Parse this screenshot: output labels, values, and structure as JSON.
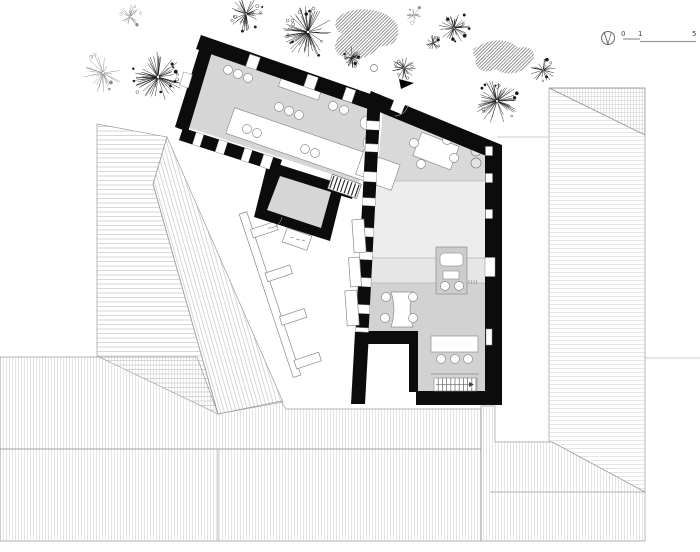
{
  "canvas": {
    "width": 700,
    "height": 552,
    "background": "#ffffff"
  },
  "scalebar": {
    "labels": [
      "0",
      "1",
      "5"
    ]
  },
  "colors": {
    "wall": "#0c0c0c",
    "roof_stroke": "#9c9c9c",
    "faint_line": "#bcbcbc",
    "floor_hall": "#d6d6d6",
    "floor_room1": "#d9d9d9",
    "floor_room2": "#ededed",
    "floor_band": "#e6e6e6",
    "floor_room3": "#d2d2d2",
    "kitchen_block": "#cccccc",
    "furniture_stroke": "#8f8f8f",
    "tree_dark": "#1a1a1a",
    "tree_light": "#8a8a8a"
  },
  "site": {
    "roofs": [
      {
        "name": "barn-roof-west-plane",
        "points": [
          [
            97,
            124
          ],
          [
            167,
            137
          ],
          [
            153,
            184
          ],
          [
            218,
            414
          ],
          [
            97,
            356
          ]
        ],
        "hatch": "hbarn"
      },
      {
        "name": "barn-roof-east-plane",
        "points": [
          [
            167,
            137
          ],
          [
            283,
            402
          ],
          [
            218,
            414
          ],
          [
            153,
            184
          ]
        ],
        "hatch": "hsteep"
      },
      {
        "name": "south-roof-upper",
        "points": [
          [
            0,
            357
          ],
          [
            197,
            357
          ],
          [
            218,
            414
          ],
          [
            281,
            401
          ],
          [
            286,
            409
          ],
          [
            481,
            409
          ],
          [
            481,
            449
          ],
          [
            0,
            449
          ]
        ],
        "hatch": "hv"
      },
      {
        "name": "south-roof-lower",
        "points": [
          [
            0,
            449
          ],
          [
            481,
            449
          ],
          [
            481,
            541
          ],
          [
            0,
            541
          ]
        ],
        "hatch": "hv"
      },
      {
        "name": "southeast-roof",
        "points": [
          [
            481,
            406
          ],
          [
            495,
            406
          ],
          [
            495,
            442
          ],
          [
            552,
            442
          ],
          [
            645,
            492
          ],
          [
            645,
            541
          ],
          [
            481,
            541
          ]
        ],
        "hatch": "hv"
      },
      {
        "name": "east-roof",
        "points": [
          [
            549,
            88
          ],
          [
            645,
            88
          ],
          [
            645,
            492
          ],
          [
            552,
            442
          ],
          [
            549,
            442
          ]
        ],
        "hatch": "hh"
      },
      {
        "name": "east-roof-hip",
        "points": [
          [
            549,
            88
          ],
          [
            645,
            88
          ],
          [
            645,
            135
          ]
        ],
        "hatch": "hv"
      }
    ],
    "ridge_lines": [
      [
        [
          153,
          184
        ],
        [
          218,
          414
        ]
      ],
      [
        [
          218,
          449
        ],
        [
          218,
          541
        ]
      ],
      [
        [
          490,
          492
        ],
        [
          645,
          492
        ]
      ],
      [
        [
          549,
          88
        ],
        [
          645,
          135
        ]
      ]
    ],
    "faint_lines": [
      [
        [
          497,
          137
        ],
        [
          548,
          137
        ]
      ],
      [
        [
          645,
          358
        ],
        [
          700,
          358
        ]
      ]
    ],
    "hedges": [
      "M347,12 C366,5 391,12 397,25 C402,37 393,48 380,46 C372,58 352,63 341,56 C331,50 335,40 342,34 C331,28 334,17 347,12 Z",
      "M481,45 C493,38 511,39 518,48 C531,44 539,54 531,63 C523,74 504,77 496,69 C485,75 473,69 476,58 C470,51 473,48 481,45 Z"
    ],
    "trees": [
      {
        "x": 103,
        "y": 73,
        "r": 20,
        "n": 26,
        "light": true
      },
      {
        "x": 158,
        "y": 77,
        "r": 26,
        "n": 55,
        "light": false
      },
      {
        "x": 130,
        "y": 17,
        "r": 13,
        "n": 22,
        "light": true
      },
      {
        "x": 246,
        "y": 14,
        "r": 17,
        "n": 38,
        "light": false
      },
      {
        "x": 308,
        "y": 32,
        "r": 26,
        "n": 58,
        "light": false
      },
      {
        "x": 352,
        "y": 57,
        "r": 11,
        "n": 26,
        "light": false
      },
      {
        "x": 414,
        "y": 15,
        "r": 9,
        "n": 16,
        "light": true
      },
      {
        "x": 454,
        "y": 28,
        "r": 16,
        "n": 36,
        "light": false
      },
      {
        "x": 433,
        "y": 43,
        "r": 8,
        "n": 18,
        "light": false
      },
      {
        "x": 404,
        "y": 68,
        "r": 13,
        "n": 26,
        "light": false
      },
      {
        "x": 543,
        "y": 70,
        "r": 13,
        "n": 26,
        "light": false
      },
      {
        "x": 497,
        "y": 101,
        "r": 23,
        "n": 50,
        "light": false
      }
    ],
    "dots": [
      [
        374,
        68,
        3.5
      ]
    ]
  },
  "building": {
    "floors": [
      {
        "name": "floor-hall",
        "points": [
          [
            212,
            45
          ],
          [
            375,
            102
          ],
          [
            359,
            183
          ],
          [
            183,
            126
          ]
        ],
        "fill": "floor_hall"
      },
      {
        "name": "floor-porch",
        "points": [
          [
            280,
            176
          ],
          [
            331,
            192
          ],
          [
            321,
            228
          ],
          [
            267,
            210
          ]
        ],
        "fill": "floor_hall"
      },
      {
        "name": "floor-room1",
        "points": [
          [
            383,
            108
          ],
          [
            486,
            151
          ],
          [
            486,
            181
          ],
          [
            377,
            181
          ]
        ],
        "fill": "floor_room1"
      },
      {
        "name": "floor-room2",
        "points": [
          [
            377,
            181
          ],
          [
            486,
            181
          ],
          [
            486,
            258
          ],
          [
            372,
            258
          ]
        ],
        "fill": "floor_room2"
      },
      {
        "name": "floor-band",
        "points": [
          [
            372,
            258
          ],
          [
            486,
            258
          ],
          [
            486,
            283
          ],
          [
            371,
            283
          ]
        ],
        "fill": "floor_band"
      },
      {
        "name": "floor-room3",
        "points": [
          [
            363,
            283
          ],
          [
            486,
            283
          ],
          [
            486,
            392
          ],
          [
            416,
            392
          ],
          [
            416,
            332
          ],
          [
            363,
            332
          ]
        ],
        "fill": "floor_room3"
      }
    ],
    "floor_lines": [
      [
        [
          378,
          181
        ],
        [
          486,
          181
        ]
      ],
      [
        [
          372,
          258
        ],
        [
          486,
          258
        ]
      ],
      [
        [
          371,
          283
        ],
        [
          486,
          283
        ]
      ]
    ],
    "walls": [
      {
        "name": "wall-west-wing-north",
        "points": [
          [
            201,
            35
          ],
          [
            379,
            97
          ],
          [
            374,
            111
          ],
          [
            196,
            49
          ]
        ]
      },
      {
        "name": "wall-west-wing-west",
        "points": [
          [
            203,
            37
          ],
          [
            175,
            127
          ],
          [
            188,
            132
          ],
          [
            215,
            42
          ]
        ]
      },
      {
        "name": "wall-porch",
        "points": [
          [
            268,
            161
          ],
          [
            344,
            185
          ],
          [
            330,
            241
          ],
          [
            254,
            217
          ]
        ]
      },
      {
        "name": "wall-junction",
        "points": [
          [
            333,
            177
          ],
          [
            356,
            184
          ],
          [
            352,
            199
          ],
          [
            329,
            192
          ]
        ]
      },
      {
        "name": "wall-east-wing-north",
        "points": [
          [
            371,
            91
          ],
          [
            502,
            145
          ],
          [
            496,
            160
          ],
          [
            365,
            106
          ]
        ]
      },
      {
        "name": "wall-east-wing-east",
        "points": [
          [
            485,
            149
          ],
          [
            502,
            145
          ],
          [
            502,
            405
          ],
          [
            485,
            405
          ]
        ]
      },
      {
        "name": "wall-east-wing-south",
        "points": [
          [
            416,
            391
          ],
          [
            502,
            391
          ],
          [
            502,
            405
          ],
          [
            416,
            405
          ]
        ]
      },
      {
        "name": "wall-notch-top",
        "points": [
          [
            357,
            331
          ],
          [
            418,
            331
          ],
          [
            418,
            344
          ],
          [
            357,
            344
          ]
        ]
      },
      {
        "name": "wall-notch-right",
        "points": [
          [
            409,
            344
          ],
          [
            418,
            344
          ],
          [
            418,
            392
          ],
          [
            409,
            392
          ]
        ]
      },
      {
        "name": "wall-party-south",
        "points": [
          [
            355,
            332
          ],
          [
            369,
            332
          ],
          [
            365,
            404
          ],
          [
            351,
            404
          ]
        ]
      }
    ],
    "checkered_walls": [
      {
        "name": "wall-hall-south",
        "from": [
          181,
          134
        ],
        "to": [
          280,
          166
        ],
        "thickness": 13,
        "pattern": [
          14,
          8,
          16,
          9,
          18,
          8,
          12,
          10,
          16
        ]
      },
      {
        "name": "wall-party",
        "from": [
          374,
          103
        ],
        "to": [
          362,
          332
        ],
        "thickness": 13,
        "pattern": [
          18,
          9,
          14,
          8,
          20,
          10,
          16,
          8,
          22,
          9,
          15,
          8,
          18,
          9
        ]
      }
    ],
    "window_gaps": [
      {
        "cx": 253,
        "cy": 62,
        "w": 11,
        "h": 13,
        "rot": 19,
        "stroke": true
      },
      {
        "cx": 311,
        "cy": 82,
        "w": 11,
        "h": 13,
        "rot": 19,
        "stroke": true
      },
      {
        "cx": 349,
        "cy": 95,
        "w": 10,
        "h": 13,
        "rot": 19,
        "stroke": true
      },
      {
        "cx": 186,
        "cy": 80,
        "w": 9,
        "h": 14,
        "rot": 17,
        "stroke": true
      },
      {
        "cx": 399,
        "cy": 104,
        "w": 12,
        "h": 17,
        "rot": 23,
        "stroke": false
      },
      {
        "cx": 489,
        "cy": 151,
        "w": 7,
        "h": 9,
        "rot": 0,
        "stroke": true
      },
      {
        "cx": 489,
        "cy": 178,
        "w": 7,
        "h": 9,
        "rot": 0,
        "stroke": true
      },
      {
        "cx": 489,
        "cy": 214,
        "w": 7,
        "h": 9,
        "rot": 0,
        "stroke": true
      },
      {
        "cx": 490,
        "cy": 267,
        "w": 10,
        "h": 19,
        "rot": 0,
        "stroke": true
      },
      {
        "cx": 489,
        "cy": 337,
        "w": 6,
        "h": 16,
        "rot": 0,
        "stroke": true
      }
    ],
    "furniture": {
      "rect_tables": [
        {
          "name": "hall-long-table",
          "cx": 313,
          "cy": 149,
          "w": 175,
          "h": 27,
          "rot": 19
        },
        {
          "name": "hall-cabinet",
          "cx": 300,
          "cy": 88,
          "w": 42,
          "h": 11,
          "rot": 19
        },
        {
          "name": "hall-sideboard",
          "cx": 366,
          "cy": 164,
          "w": 13,
          "h": 26,
          "rot": 19
        },
        {
          "name": "entry-bench",
          "cx": 427,
          "cy": 122,
          "w": 28,
          "h": 8,
          "rot": 23
        },
        {
          "name": "room1-table",
          "cx": 436,
          "cy": 151,
          "w": 40,
          "h": 25,
          "rot": 21
        },
        {
          "name": "room3-table",
          "cx": 454.5,
          "cy": 344,
          "w": 47,
          "h": 16,
          "rot": 0
        }
      ],
      "desk_path": "M391,292 L413,292 C409,304 409,315 413,327 L391,327 C395,315 395,304 391,292 Z",
      "chairs": [
        [
          228,
          70
        ],
        [
          238,
          74
        ],
        [
          248,
          78
        ],
        [
          279,
          107
        ],
        [
          289,
          111
        ],
        [
          299,
          115
        ],
        [
          247,
          129
        ],
        [
          257,
          133
        ],
        [
          305,
          149
        ],
        [
          315,
          153
        ],
        [
          333,
          106
        ],
        [
          344,
          110
        ],
        [
          414,
          143
        ],
        [
          447,
          140
        ],
        [
          421,
          164
        ],
        [
          454,
          158
        ],
        [
          386,
          297
        ],
        [
          413,
          297
        ],
        [
          385,
          318
        ],
        [
          413,
          318
        ],
        [
          441,
          359
        ],
        [
          455,
          359
        ],
        [
          468,
          359
        ]
      ],
      "chairs_large": [
        [
          367,
          123
        ],
        [
          370,
          143
        ]
      ],
      "planters": [
        [
          476,
          151
        ],
        [
          476,
          163
        ]
      ],
      "shelf_line": [
        [
          431,
          374
        ],
        [
          479,
          374
        ]
      ]
    },
    "kitchen": {
      "block": [
        436,
        247,
        31,
        47
      ],
      "sink": [
        440,
        253,
        23,
        13
      ],
      "hob": [
        443,
        271,
        16,
        8
      ],
      "circles": [
        [
          445,
          286,
          4.5
        ],
        [
          459,
          286,
          4.5
        ]
      ],
      "ticks_x": [
        469,
        471.5,
        474,
        476.5
      ],
      "ticks_y": [
        280,
        284
      ]
    },
    "bench": {
      "from": [
        243,
        213
      ],
      "dir": [
        0.314,
        0.949
      ],
      "length": 172,
      "width": 8,
      "stubs_t": [
        18,
        64,
        110,
        156
      ],
      "stub_len": 26,
      "stub_width": 9
    },
    "shutters": [
      {
        "cx": 359,
        "cy": 236,
        "w": 12,
        "h": 33,
        "rot": -4
      },
      {
        "cx": 355,
        "cy": 272,
        "w": 11,
        "h": 29,
        "rot": -4
      },
      {
        "cx": 352,
        "cy": 308,
        "w": 12,
        "h": 35,
        "rot": -4
      }
    ],
    "stairs1": {
      "base": [
        334,
        176
      ],
      "angle_deg": 19,
      "steps": 7,
      "step": 3.8,
      "width": 13
    },
    "stairs2": {
      "x1": 434,
      "y1": 378,
      "x2": 477,
      "y2": 391,
      "step": 4.2
    },
    "doors": {
      "porch_arc": "M282,217 A13 13 0 0 1 268,228",
      "entry_arc": "M408,105 A14 14 0 0 1 395,116"
    },
    "mat": {
      "cx": 297,
      "cy": 239,
      "w": 26,
      "h": 15,
      "rot": 19
    },
    "entry_arrow": [
      [
        399,
        79
      ],
      [
        414,
        83
      ],
      [
        401,
        89
      ]
    ]
  }
}
